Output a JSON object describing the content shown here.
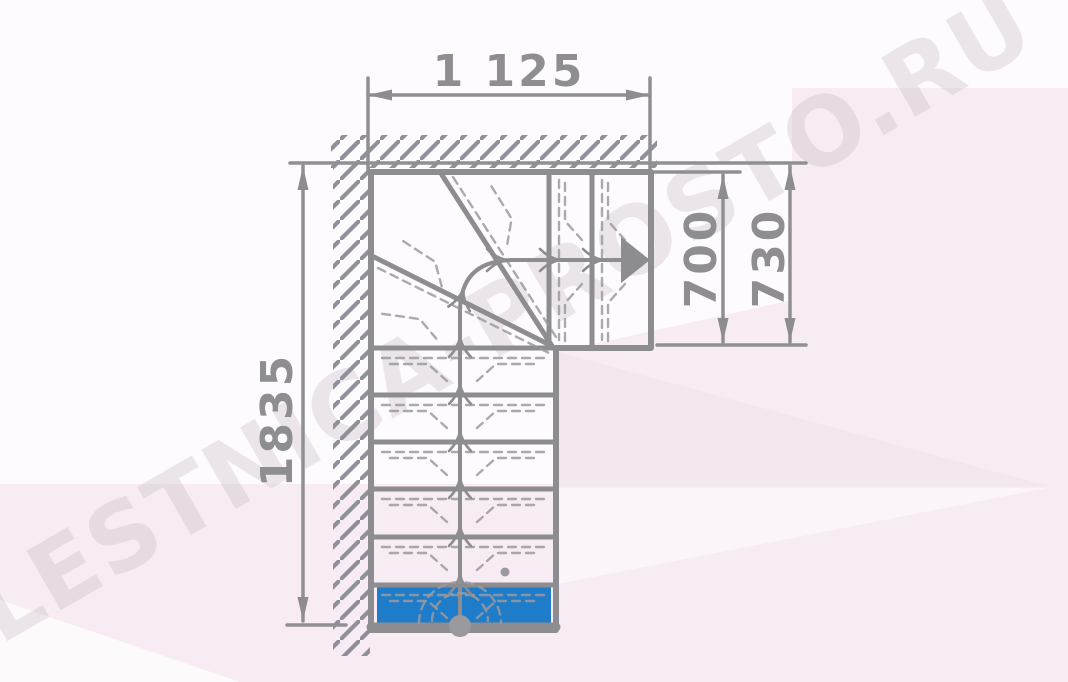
{
  "drawing": {
    "type": "l-shaped-winder-staircase-plan-top-view",
    "dimensions": {
      "top_width": "1 125",
      "right_inner": "700",
      "right_outer": "730",
      "left_height": "1835"
    },
    "watermark": "LESTNICA-PROSTO.RU",
    "colors": {
      "line_gray": "#8c8c91",
      "first_step_blue": "#1e7cc8",
      "background_pink": "#f7ecf3",
      "watermark_gray": "#b9a9b9"
    },
    "icons": {
      "direction_arrow": "filled triangle pointing right at end of walking line",
      "walk_start_dot": "filled circle at bottom of walking line",
      "wall_hatch": "45-degree hatching along top and left walls"
    }
  }
}
